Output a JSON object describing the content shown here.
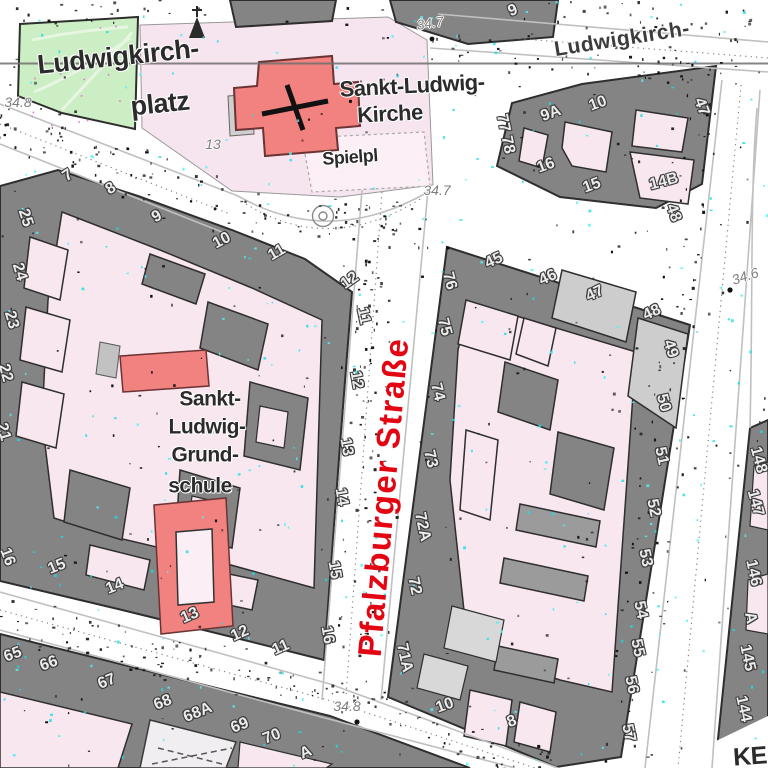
{
  "streets": {
    "main_label": {
      "text": "Pfalzburger Straße",
      "x": 383,
      "y": 497,
      "rot": -85,
      "size": 33,
      "color": "#e30612"
    },
    "names": [
      {
        "text": "Ludwigkirch-",
        "x": 622,
        "y": 39,
        "rot": -9,
        "size": 21
      }
    ]
  },
  "places": [
    {
      "text": "Ludwigkirch-",
      "x": 118,
      "y": 57,
      "rot": -6,
      "size": 27
    },
    {
      "text": "platz",
      "x": 160,
      "y": 104,
      "rot": -6,
      "size": 27
    },
    {
      "text": "Sankt-Ludwig-",
      "x": 412,
      "y": 86,
      "rot": -3,
      "size": 22
    },
    {
      "text": "Kirche",
      "x": 390,
      "y": 114,
      "rot": -3,
      "size": 22
    },
    {
      "text": "Spielpl",
      "x": 350,
      "y": 157,
      "rot": -4,
      "size": 18
    },
    {
      "text": "Sankt-",
      "x": 210,
      "y": 399,
      "rot": 0,
      "size": 21
    },
    {
      "text": "Ludwig-",
      "x": 207,
      "y": 427,
      "rot": 0,
      "size": 21
    },
    {
      "text": "Grund-",
      "x": 205,
      "y": 455,
      "rot": 0,
      "size": 21
    },
    {
      "text": "schule",
      "x": 200,
      "y": 486,
      "rot": 0,
      "size": 21
    },
    {
      "text": "KE",
      "x": 750,
      "y": 757,
      "rot": -4,
      "size": 25
    }
  ],
  "house_numbers": [
    {
      "text": "7",
      "x": 68,
      "y": 176,
      "rot": -33
    },
    {
      "text": "8",
      "x": 111,
      "y": 189,
      "rot": -33
    },
    {
      "text": "9",
      "x": 157,
      "y": 217,
      "rot": -28
    },
    {
      "text": "10",
      "x": 222,
      "y": 241,
      "rot": -28
    },
    {
      "text": "11",
      "x": 277,
      "y": 253,
      "rot": -30
    },
    {
      "text": "12",
      "x": 350,
      "y": 281,
      "rot": -35
    },
    {
      "text": "25",
      "x": 25,
      "y": 218,
      "rot": 72
    },
    {
      "text": "24",
      "x": 19,
      "y": 272,
      "rot": 73
    },
    {
      "text": "23",
      "x": 11,
      "y": 320,
      "rot": 74
    },
    {
      "text": "22",
      "x": 5,
      "y": 373,
      "rot": 74
    },
    {
      "text": "21",
      "x": 3,
      "y": 432,
      "rot": 74
    },
    {
      "text": "11",
      "x": 363,
      "y": 316,
      "rot": 78
    },
    {
      "text": "12",
      "x": 356,
      "y": 380,
      "rot": 80
    },
    {
      "text": "13",
      "x": 346,
      "y": 447,
      "rot": 80
    },
    {
      "text": "14",
      "x": 341,
      "y": 497,
      "rot": 80
    },
    {
      "text": "15",
      "x": 334,
      "y": 570,
      "rot": 80
    },
    {
      "text": "16",
      "x": 327,
      "y": 635,
      "rot": 80
    },
    {
      "text": "16",
      "x": 7,
      "y": 557,
      "rot": 70
    },
    {
      "text": "15",
      "x": 57,
      "y": 567,
      "rot": -22
    },
    {
      "text": "14",
      "x": 115,
      "y": 587,
      "rot": -22
    },
    {
      "text": "13",
      "x": 190,
      "y": 616,
      "rot": -24
    },
    {
      "text": "12",
      "x": 240,
      "y": 634,
      "rot": -24
    },
    {
      "text": "11",
      "x": 281,
      "y": 648,
      "rot": -24
    },
    {
      "text": "65",
      "x": 13,
      "y": 655,
      "rot": -20
    },
    {
      "text": "66",
      "x": 49,
      "y": 664,
      "rot": -20
    },
    {
      "text": "67",
      "x": 107,
      "y": 682,
      "rot": -22
    },
    {
      "text": "68",
      "x": 163,
      "y": 703,
      "rot": -22
    },
    {
      "text": "68A",
      "x": 198,
      "y": 713,
      "rot": -22
    },
    {
      "text": "69",
      "x": 240,
      "y": 726,
      "rot": -22
    },
    {
      "text": "70",
      "x": 272,
      "y": 737,
      "rot": -22
    },
    {
      "text": "A",
      "x": 306,
      "y": 753,
      "rot": -22
    },
    {
      "text": "10",
      "x": 445,
      "y": 706,
      "rot": -20
    },
    {
      "text": "8",
      "x": 512,
      "y": 722,
      "rot": -20
    },
    {
      "text": "76",
      "x": 449,
      "y": 281,
      "rot": 75
    },
    {
      "text": "75",
      "x": 444,
      "y": 327,
      "rot": 75
    },
    {
      "text": "74",
      "x": 437,
      "y": 392,
      "rot": 76
    },
    {
      "text": "73",
      "x": 430,
      "y": 459,
      "rot": 76
    },
    {
      "text": "72A",
      "x": 422,
      "y": 527,
      "rot": 78
    },
    {
      "text": "72",
      "x": 414,
      "y": 586,
      "rot": 78
    },
    {
      "text": "71A",
      "x": 404,
      "y": 658,
      "rot": 78
    },
    {
      "text": "45",
      "x": 494,
      "y": 261,
      "rot": -25
    },
    {
      "text": "46",
      "x": 548,
      "y": 278,
      "rot": -25
    },
    {
      "text": "47",
      "x": 595,
      "y": 294,
      "rot": -25
    },
    {
      "text": "48",
      "x": 652,
      "y": 313,
      "rot": -25
    },
    {
      "text": "49",
      "x": 670,
      "y": 349,
      "rot": 72
    },
    {
      "text": "50",
      "x": 663,
      "y": 403,
      "rot": 75
    },
    {
      "text": "51",
      "x": 661,
      "y": 456,
      "rot": 78
    },
    {
      "text": "52",
      "x": 653,
      "y": 508,
      "rot": 78
    },
    {
      "text": "53",
      "x": 645,
      "y": 558,
      "rot": 78
    },
    {
      "text": "54",
      "x": 640,
      "y": 610,
      "rot": 78
    },
    {
      "text": "55",
      "x": 637,
      "y": 648,
      "rot": 78
    },
    {
      "text": "56",
      "x": 631,
      "y": 685,
      "rot": 78
    },
    {
      "text": "57",
      "x": 628,
      "y": 733,
      "rot": 78
    },
    {
      "text": "9",
      "x": 513,
      "y": 11,
      "rot": -22
    },
    {
      "text": "77 78",
      "x": 505,
      "y": 134,
      "rot": 78
    },
    {
      "text": "9A",
      "x": 551,
      "y": 114,
      "rot": -20
    },
    {
      "text": "10",
      "x": 598,
      "y": 104,
      "rot": -20
    },
    {
      "text": "16",
      "x": 546,
      "y": 166,
      "rot": -20
    },
    {
      "text": "15",
      "x": 592,
      "y": 186,
      "rot": -20
    },
    {
      "text": "14B",
      "x": 664,
      "y": 182,
      "rot": -15
    },
    {
      "text": "47",
      "x": 701,
      "y": 107,
      "rot": 70
    },
    {
      "text": "48",
      "x": 673,
      "y": 213,
      "rot": 70
    },
    {
      "text": "148",
      "x": 758,
      "y": 460,
      "rot": 75
    },
    {
      "text": "147",
      "x": 755,
      "y": 503,
      "rot": 75
    },
    {
      "text": "146",
      "x": 753,
      "y": 573,
      "rot": 78
    },
    {
      "text": "A",
      "x": 750,
      "y": 618,
      "rot": 78
    },
    {
      "text": "145",
      "x": 747,
      "y": 658,
      "rot": 78
    },
    {
      "text": "144",
      "x": 743,
      "y": 709,
      "rot": 78
    }
  ],
  "elevations": [
    {
      "text": "34.8",
      "x": 18,
      "y": 102,
      "rot": 0
    },
    {
      "text": "34.7",
      "x": 430,
      "y": 23,
      "rot": -8
    },
    {
      "text": "34.7",
      "x": 437,
      "y": 190,
      "rot": 0
    },
    {
      "text": "13",
      "x": 213,
      "y": 144,
      "rot": 0
    },
    {
      "text": "34.8",
      "x": 347,
      "y": 706,
      "rot": 0
    },
    {
      "text": "34.6",
      "x": 745,
      "y": 276,
      "rot": -18
    }
  ],
  "colors": {
    "building": "#848484",
    "courtyard": "#f9e7f0",
    "landmark_red": "#f1827f",
    "park_green": "#cceec4",
    "light_building": "#cdcdcd",
    "street_label_red": "#e30612"
  }
}
